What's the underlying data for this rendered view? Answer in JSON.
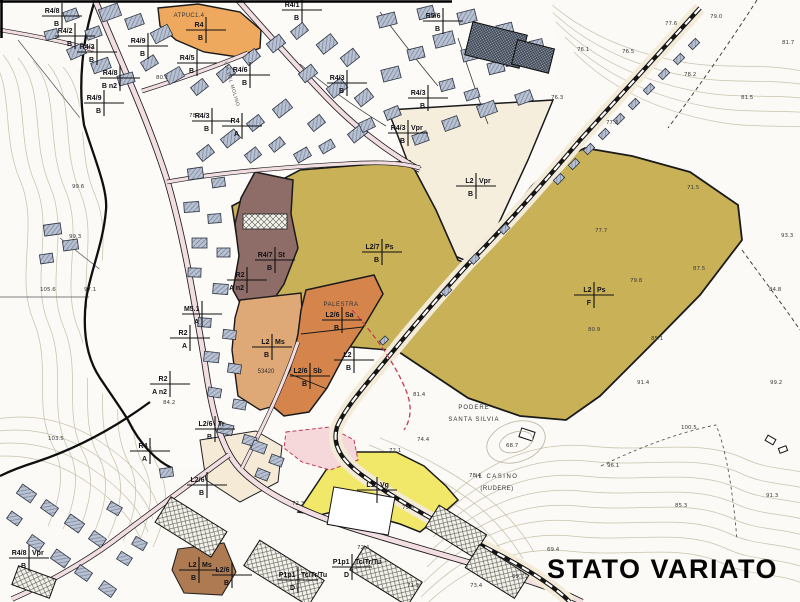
{
  "title": "STATO VARIATO",
  "map": {
    "colors": {
      "olive": "#c9b157",
      "cream": "#f6eedd",
      "orange": "#d5854b",
      "orange_light": "#dfa877",
      "brown": "#8e6c68",
      "brown_dark": "#ad7a52",
      "yellow": "#f1e768",
      "road": "#f2dee2",
      "building": "#b9c2d2",
      "red_dash": "#c43a55",
      "atpuc_orange": "#efa95f",
      "pink_zone": "#f6d8db"
    },
    "zone_markers": [
      {
        "x": 476,
        "y": 186,
        "main": "L2",
        "side": "Vpr",
        "sub": "B"
      },
      {
        "x": 382,
        "y": 252,
        "main": "L2/7",
        "side": "Ps",
        "sub": "B"
      },
      {
        "x": 594,
        "y": 295,
        "main": "L2",
        "side": "Ps",
        "sub": "F"
      },
      {
        "x": 275,
        "y": 260,
        "main": "R4/7",
        "side": "St",
        "sub": "B"
      },
      {
        "x": 272,
        "y": 347,
        "main": "L2",
        "side": "Ms",
        "sub": "B"
      },
      {
        "x": 342,
        "y": 320,
        "main": "L2/6",
        "side": "Sa",
        "sub": "B"
      },
      {
        "x": 310,
        "y": 376,
        "main": "L2/6",
        "side": "Sb",
        "sub": "B"
      },
      {
        "x": 354,
        "y": 360,
        "main": "L2",
        "side": "",
        "sub": "B"
      },
      {
        "x": 377,
        "y": 490,
        "main": "L1",
        "side": "Vg",
        "sub": ""
      },
      {
        "x": 206,
        "y": 30,
        "main": "R4",
        "side": "",
        "sub": "B"
      },
      {
        "x": 62,
        "y": 16,
        "main": "R4/8",
        "side": "",
        "sub": "B"
      },
      {
        "x": 75,
        "y": 36,
        "main": "R4/2",
        "side": "",
        "sub": "B"
      },
      {
        "x": 97,
        "y": 52,
        "main": "R4/3",
        "side": "",
        "sub": "B"
      },
      {
        "x": 148,
        "y": 46,
        "main": "R4/9",
        "side": "",
        "sub": "B"
      },
      {
        "x": 120,
        "y": 78,
        "main": "R4/8",
        "side": "",
        "sub": "B n2"
      },
      {
        "x": 104,
        "y": 103,
        "main": "R4/9",
        "side": "",
        "sub": "B"
      },
      {
        "x": 197,
        "y": 63,
        "main": "R4/5",
        "side": "",
        "sub": "B"
      },
      {
        "x": 250,
        "y": 75,
        "main": "R4/6",
        "side": "",
        "sub": "B"
      },
      {
        "x": 212,
        "y": 121,
        "main": "R4/3",
        "side": "",
        "sub": "B"
      },
      {
        "x": 242,
        "y": 126,
        "main": "R4",
        "side": "",
        "sub": "A"
      },
      {
        "x": 347,
        "y": 83,
        "main": "R4/3",
        "side": "",
        "sub": "B"
      },
      {
        "x": 443,
        "y": 21,
        "main": "R5/6",
        "side": "",
        "sub": "B"
      },
      {
        "x": 428,
        "y": 98,
        "main": "R4/3",
        "side": "",
        "sub": "B"
      },
      {
        "x": 408,
        "y": 133,
        "main": "R4/3",
        "side": "Vpr",
        "sub": "B"
      },
      {
        "x": 302,
        "y": 10,
        "main": "R4/1",
        "side": "",
        "sub": "B"
      },
      {
        "x": 190,
        "y": 338,
        "main": "R2",
        "side": "",
        "sub": "A"
      },
      {
        "x": 247,
        "y": 280,
        "main": "R2",
        "side": "",
        "sub": "A n2"
      },
      {
        "x": 170,
        "y": 384,
        "main": "R2",
        "side": "",
        "sub": "A n2"
      },
      {
        "x": 202,
        "y": 314,
        "main": "M5.1",
        "side": "",
        "sub": "A"
      },
      {
        "x": 150,
        "y": 451,
        "main": "R4",
        "side": "",
        "sub": "A"
      },
      {
        "x": 29,
        "y": 558,
        "main": "R4/8",
        "side": "Vpr",
        "sub": "B"
      },
      {
        "x": 215,
        "y": 429,
        "main": "L2/6",
        "side": "Tr",
        "sub": "B"
      },
      {
        "x": 207,
        "y": 485,
        "main": "L2/6",
        "side": "",
        "sub": "B"
      },
      {
        "x": 199,
        "y": 570,
        "main": "L2",
        "side": "Ms",
        "sub": "B"
      },
      {
        "x": 232,
        "y": 575,
        "main": "L2/6",
        "side": "",
        "sub": "B"
      },
      {
        "x": 298,
        "y": 580,
        "main": "P1p1",
        "side": "Tc/Tr/Tu",
        "sub": "D"
      },
      {
        "x": 352,
        "y": 567,
        "main": "P1p1",
        "side": "Tc/Tr/Tu",
        "sub": "D"
      }
    ],
    "spot_elevations": [
      {
        "x": 72,
        "y": 188,
        "v": "99.6"
      },
      {
        "x": 69,
        "y": 238,
        "v": "99.3"
      },
      {
        "x": 40,
        "y": 291,
        "v": "105.6"
      },
      {
        "x": 84,
        "y": 291,
        "v": "97.1"
      },
      {
        "x": 156,
        "y": 79,
        "v": "80.1"
      },
      {
        "x": 189,
        "y": 117,
        "v": "78.6"
      },
      {
        "x": 163,
        "y": 404,
        "v": "84.2"
      },
      {
        "x": 48,
        "y": 440,
        "v": "103.5"
      },
      {
        "x": 665,
        "y": 25,
        "v": "77.6"
      },
      {
        "x": 710,
        "y": 18,
        "v": "79.0"
      },
      {
        "x": 577,
        "y": 51,
        "v": "76.1"
      },
      {
        "x": 622,
        "y": 53,
        "v": "76.5"
      },
      {
        "x": 782,
        "y": 44,
        "v": "81.7"
      },
      {
        "x": 551,
        "y": 99,
        "v": "76.3"
      },
      {
        "x": 684,
        "y": 76,
        "v": "78.2"
      },
      {
        "x": 741,
        "y": 99,
        "v": "81.5"
      },
      {
        "x": 606,
        "y": 124,
        "v": "77.3"
      },
      {
        "x": 687,
        "y": 189,
        "v": "71.5"
      },
      {
        "x": 595,
        "y": 232,
        "v": "77.7"
      },
      {
        "x": 693,
        "y": 270,
        "v": "87.5"
      },
      {
        "x": 630,
        "y": 282,
        "v": "79.8"
      },
      {
        "x": 781,
        "y": 237,
        "v": "93.3"
      },
      {
        "x": 769,
        "y": 291,
        "v": "84.8"
      },
      {
        "x": 588,
        "y": 331,
        "v": "80.9"
      },
      {
        "x": 651,
        "y": 340,
        "v": "85.1"
      },
      {
        "x": 506,
        "y": 447,
        "v": "68.7"
      },
      {
        "x": 417,
        "y": 441,
        "v": "74.4"
      },
      {
        "x": 389,
        "y": 452,
        "v": "72.1"
      },
      {
        "x": 413,
        "y": 396,
        "v": "81.4"
      },
      {
        "x": 469,
        "y": 477,
        "v": "78.4"
      },
      {
        "x": 402,
        "y": 509,
        "v": "79.4"
      },
      {
        "x": 292,
        "y": 505,
        "v": "72.3"
      },
      {
        "x": 357,
        "y": 549,
        "v": "72.4"
      },
      {
        "x": 407,
        "y": 587,
        "v": "71.5"
      },
      {
        "x": 470,
        "y": 587,
        "v": "73.4"
      },
      {
        "x": 512,
        "y": 578,
        "v": "69.7"
      },
      {
        "x": 547,
        "y": 551,
        "v": "69.4"
      },
      {
        "x": 637,
        "y": 384,
        "v": "91.4"
      },
      {
        "x": 770,
        "y": 384,
        "v": "99.2"
      },
      {
        "x": 681,
        "y": 429,
        "v": "100.5"
      },
      {
        "x": 607,
        "y": 467,
        "v": "96.1"
      },
      {
        "x": 675,
        "y": 507,
        "v": "85.3"
      },
      {
        "x": 766,
        "y": 497,
        "v": "91.3"
      }
    ],
    "place_labels": [
      {
        "x": 474,
        "y": 409,
        "text": "PODERE",
        "size": 5.5,
        "ls": 1
      },
      {
        "x": 474,
        "y": 421,
        "text": "SANTA  SILVIA",
        "size": 5.5,
        "ls": 1
      },
      {
        "x": 497,
        "y": 478,
        "text": "IL  CASINO",
        "size": 6,
        "ls": 1.5
      },
      {
        "x": 497,
        "y": 490,
        "text": "(RUDERE)",
        "size": 5.5,
        "ls": 0.5
      },
      {
        "x": 341,
        "y": 306,
        "text": "PALESTRA",
        "size": 5,
        "ls": 0.5
      },
      {
        "x": 266,
        "y": 373,
        "text": "53420",
        "size": 6.5,
        "ls": 0
      },
      {
        "x": 189,
        "y": 17,
        "text": "ATPUC1.4",
        "size": 7,
        "ls": 0.3,
        "color": "#c2272f",
        "bold": true
      }
    ],
    "road_names": [
      {
        "x": 224,
        "y": 62,
        "angle": 74,
        "text": "VIA DEL MOLINO"
      }
    ]
  }
}
